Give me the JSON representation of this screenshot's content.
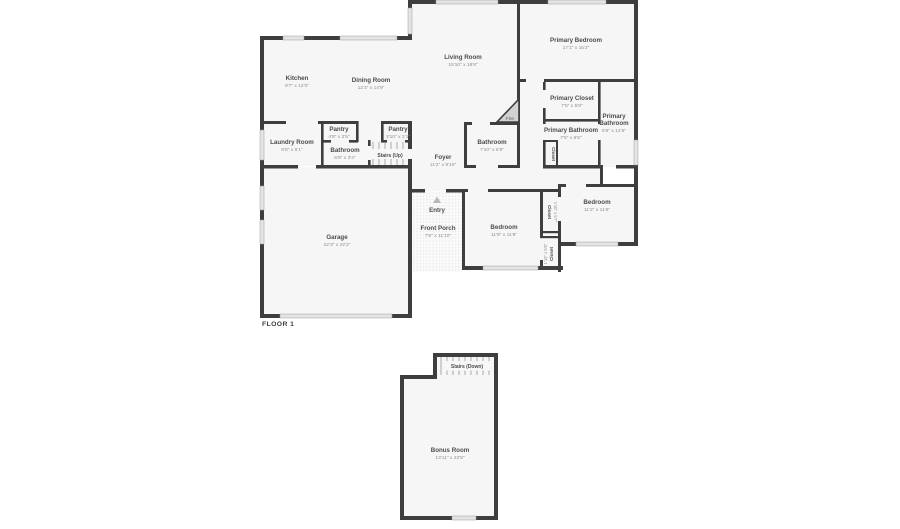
{
  "floor1": {
    "label": "FLOOR 1",
    "rooms": {
      "kitchen": {
        "name": "Kitchen",
        "dims": "9'7\" x 12'0\""
      },
      "dining": {
        "name": "Dining Room",
        "dims": "12'3\" x 14'9\""
      },
      "living": {
        "name": "Living Room",
        "dims": "15'10\" x 18'8\""
      },
      "primary_bedroom": {
        "name": "Primary Bedroom",
        "dims": "17'1\" x 15'2\""
      },
      "primary_closet": {
        "name": "Primary Closet",
        "dims": "7'5\" x 5'8\""
      },
      "primary_bath_main": {
        "name_line1": "Primary",
        "name_line2": "Bathroom",
        "dims": "5'9\" x 12'6\""
      },
      "primary_bath_small": {
        "name": "Primary Bathroom",
        "dims": "7'5\" x 6'5\""
      },
      "closet_hall": {
        "name": "Closet"
      },
      "laundry": {
        "name": "Laundry Room",
        "dims": "8'6\" x 6'1\""
      },
      "pantry_a": {
        "name": "Pantry",
        "dims": "4'8\" x 2'5\""
      },
      "pantry_b": {
        "name": "Pantry",
        "dims": "3'10\" x 2'1\""
      },
      "bath_small": {
        "name": "Bathroom",
        "dims": "6'8\" x 3'4\""
      },
      "stairs_up": {
        "name": "Stairs (Up)"
      },
      "foyer": {
        "name": "Foyer",
        "dims": "11'2\" x 9'10\""
      },
      "bath_hall": {
        "name": "Bathroom",
        "dims": "7'10\" x 6'9\""
      },
      "fire": {
        "name": "Fire"
      },
      "garage": {
        "name": "Garage",
        "dims": "22'3\" x 22'2\""
      },
      "entry": {
        "name": "Entry"
      },
      "porch": {
        "name": "Front Porch",
        "dims": "7'5\" x 11'10\""
      },
      "bedroom_center": {
        "name": "Bedroom",
        "dims": "11'9\" x 11'9\""
      },
      "bedroom_right": {
        "name": "Bedroom",
        "dims": "11'2\" x 11'6\""
      },
      "closet_a": {
        "name": "Closet",
        "dims": "1'10\" x 5'7\""
      },
      "closet_b": {
        "name": "Closet",
        "dims": "1'10\" x 5'9\""
      }
    }
  },
  "floor2": {
    "rooms": {
      "stairs_down": {
        "name": "Stairs (Down)"
      },
      "bonus": {
        "name": "Bonus Room",
        "dims": "13'11\" x 22'8\""
      }
    }
  },
  "colors": {
    "wall": "#3e3e3e",
    "floor": "#f6f6f6",
    "window": "#e4e4e4",
    "room_text": "#4c4c4c",
    "dim_text": "#8e8e8e"
  }
}
